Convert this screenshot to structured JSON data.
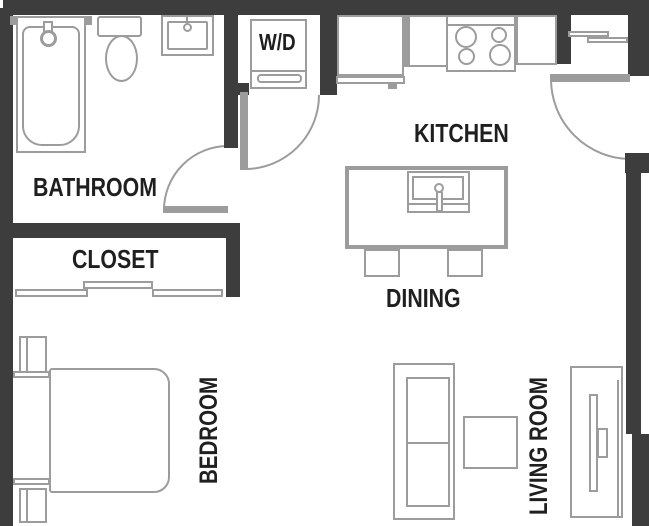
{
  "plan": {
    "type": "studio-apartment-floor-plan",
    "rooms": {
      "bathroom": "BATHROOM",
      "closet": "CLOSET",
      "kitchen": "KITCHEN",
      "dining": "DINING",
      "bedroom": "BEDROOM",
      "living_room": "LIVING ROOM",
      "laundry": "W/D"
    },
    "colors": {
      "wall": "#3d3d3d",
      "fixture_outline": "#9c9c9c",
      "label_text": "#1f1f1f",
      "background": "#ffffff"
    }
  }
}
